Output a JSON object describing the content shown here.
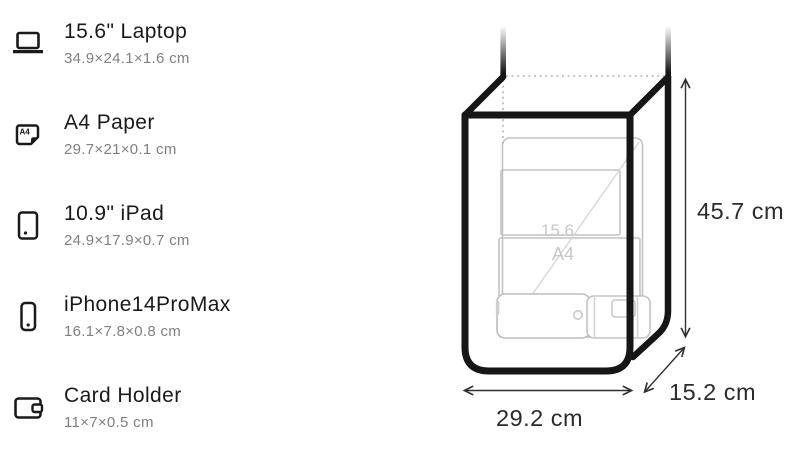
{
  "item_list": {
    "items": [
      {
        "icon": "laptop-icon",
        "name": "15.6\" Laptop",
        "dims": "34.9×24.1×1.6 cm"
      },
      {
        "icon": "a4-paper-icon",
        "name": "A4 Paper",
        "dims": "29.7×21×0.1 cm",
        "icon_text": "A4"
      },
      {
        "icon": "tablet-icon",
        "name": "10.9\" iPad",
        "dims": "24.9×17.9×0.7 cm"
      },
      {
        "icon": "phone-icon",
        "name": "iPhone14ProMax",
        "dims": "16.1×7.8×0.8 cm"
      },
      {
        "icon": "wallet-icon",
        "name": "Card Holder",
        "dims": "11×7×0.5 cm"
      }
    ]
  },
  "diagram": {
    "height_label": "45.7 cm",
    "width_label": "29.2 cm",
    "depth_label": "15.2 cm",
    "laptop_diagonal_label": "15.6",
    "paper_label": "A4"
  },
  "colors": {
    "ink": "#1a1a1a",
    "bag": "#161616",
    "muted": "#808080",
    "dim": "#2b2b2b",
    "outline": "#c3c3c3",
    "faint": "#c7c7c7"
  }
}
